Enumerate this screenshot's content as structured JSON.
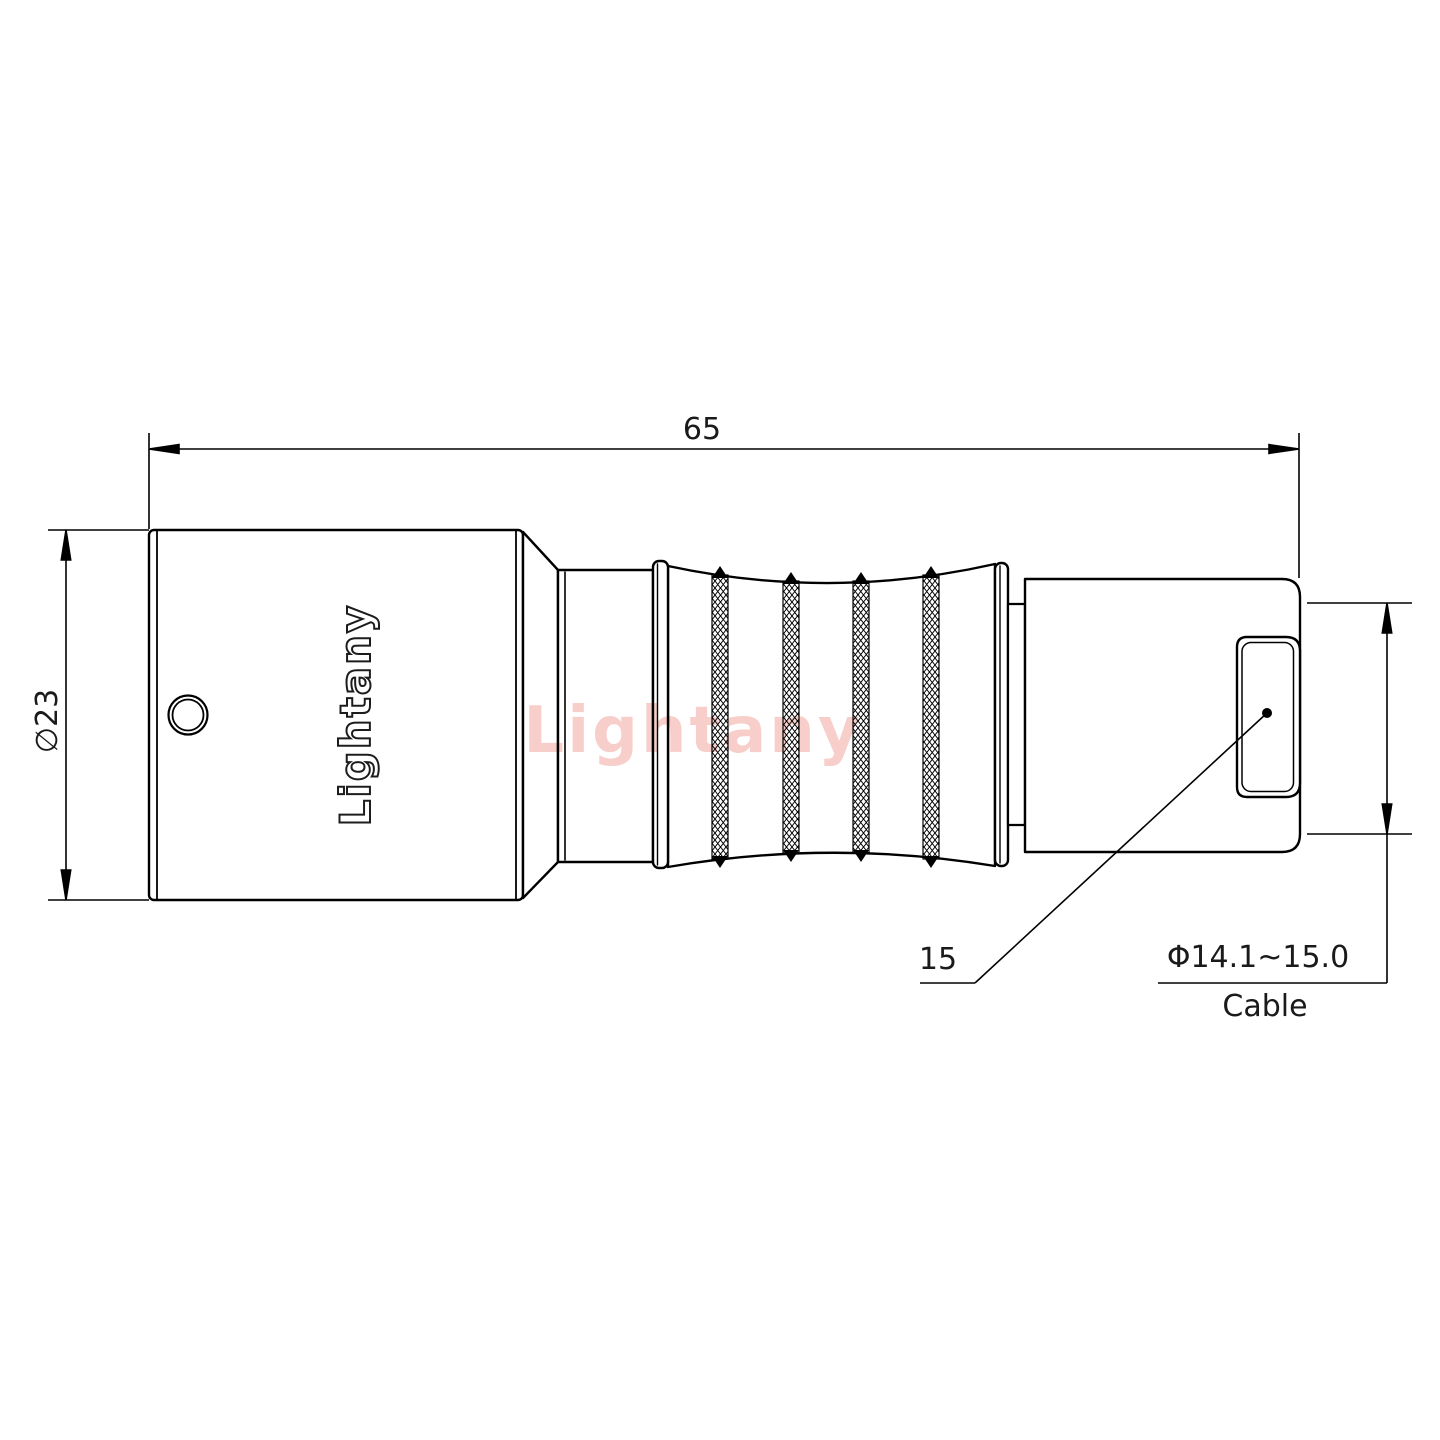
{
  "labels": {
    "overall_length": "65",
    "body_diameter": "∅23",
    "leader_value": "15",
    "cable_diameter_range": "Φ14.1~15.0",
    "cable_word": "Cable",
    "engraving": "Lightany",
    "watermark": "Lightany"
  },
  "colors": {
    "line": "#000000",
    "background": "#ffffff",
    "watermark": "#ef9d94"
  }
}
